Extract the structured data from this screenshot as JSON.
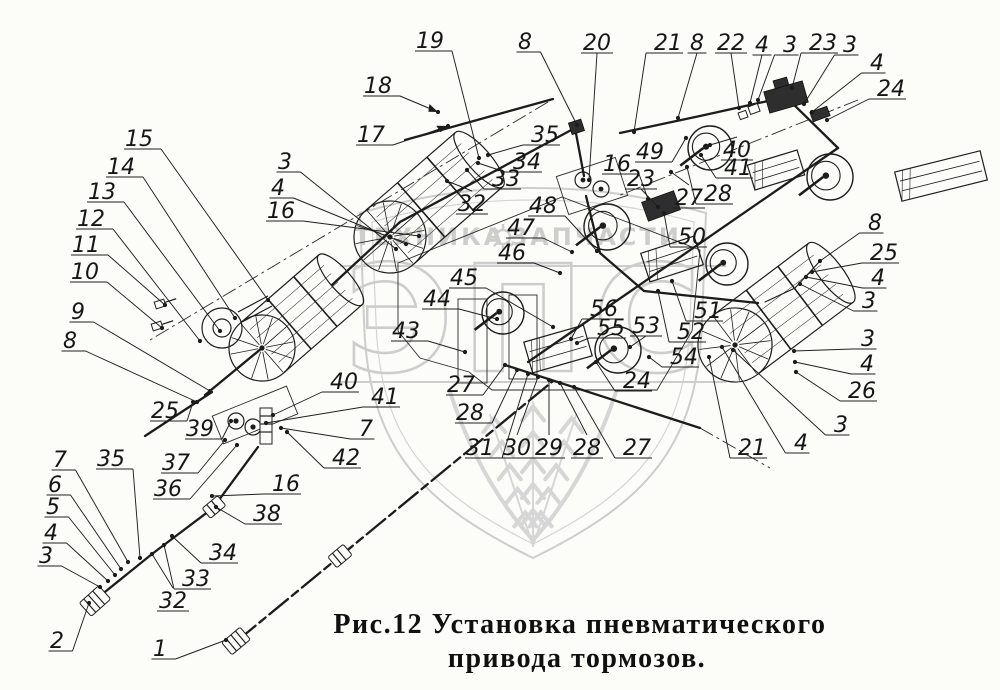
{
  "figure": {
    "caption": {
      "line1": "Рис.12 Установка пневматического",
      "line2": "привода тормозов."
    }
  },
  "watermark": {
    "brand": "ЭПС",
    "word_left": "ТЕХНИКА",
    "word_right": "ЗАПЧАСТИ",
    "color": "#cdcdcd"
  },
  "drawing": {
    "ink_color": "#1c1c1c",
    "background_color": "#fcfcf9",
    "callouts": [
      {
        "t": "19",
        "x": 430,
        "y": 40,
        "tx": 479,
        "ty": 158
      },
      {
        "t": "8",
        "x": 525,
        "y": 41,
        "tx": 577,
        "ty": 125
      },
      {
        "t": "20",
        "x": 597,
        "y": 42,
        "tx": 589,
        "ty": 180
      },
      {
        "t": "21",
        "x": 668,
        "y": 42,
        "tx": 634,
        "ty": 132
      },
      {
        "t": "8",
        "x": 697,
        "y": 42,
        "tx": 678,
        "ty": 118
      },
      {
        "t": "22",
        "x": 731,
        "y": 42,
        "tx": 739,
        "ty": 108
      },
      {
        "t": "4",
        "x": 762,
        "y": 44,
        "tx": 750,
        "ty": 103
      },
      {
        "t": "3",
        "x": 790,
        "y": 44,
        "tx": 758,
        "ty": 100
      },
      {
        "t": "23",
        "x": 823,
        "y": 42,
        "tx": 792,
        "ty": 88
      },
      {
        "t": "3",
        "x": 850,
        "y": 44,
        "tx": 804,
        "ty": 104
      },
      {
        "t": "4",
        "x": 877,
        "y": 62,
        "tx": 812,
        "ty": 112
      },
      {
        "t": "24",
        "x": 891,
        "y": 88,
        "tx": 827,
        "ty": 120
      },
      {
        "t": "18",
        "x": 378,
        "y": 85,
        "tx": 438,
        "ty": 112
      },
      {
        "t": "17",
        "x": 371,
        "y": 134,
        "tx": 448,
        "ty": 126
      },
      {
        "t": "15",
        "x": 139,
        "y": 138,
        "tx": 268,
        "ty": 300
      },
      {
        "t": "14",
        "x": 121,
        "y": 166,
        "tx": 235,
        "ty": 318
      },
      {
        "t": "13",
        "x": 102,
        "y": 191,
        "tx": 220,
        "ty": 331
      },
      {
        "t": "12",
        "x": 91,
        "y": 218,
        "tx": 200,
        "ty": 341
      },
      {
        "t": "11",
        "x": 86,
        "y": 244,
        "tx": 165,
        "ty": 305
      },
      {
        "t": "10",
        "x": 85,
        "y": 271,
        "tx": 162,
        "ty": 328
      },
      {
        "t": "9",
        "x": 78,
        "y": 311,
        "tx": 210,
        "ty": 391
      },
      {
        "t": "8",
        "x": 70,
        "y": 340,
        "tx": 197,
        "ty": 402
      },
      {
        "t": "3",
        "x": 285,
        "y": 161,
        "tx": 396,
        "ty": 249
      },
      {
        "t": "4",
        "x": 278,
        "y": 187,
        "tx": 406,
        "ty": 244
      },
      {
        "t": "16",
        "x": 281,
        "y": 210,
        "tx": 419,
        "ty": 236
      },
      {
        "t": "35",
        "x": 545,
        "y": 134,
        "tx": 488,
        "ty": 155
      },
      {
        "t": "34",
        "x": 527,
        "y": 161,
        "tx": 478,
        "ty": 163
      },
      {
        "t": "33",
        "x": 506,
        "y": 178,
        "tx": 467,
        "ty": 170
      },
      {
        "t": "32",
        "x": 472,
        "y": 203,
        "tx": 447,
        "ty": 181
      },
      {
        "t": "48",
        "x": 543,
        "y": 205,
        "tx": 597,
        "ty": 251
      },
      {
        "t": "47",
        "x": 521,
        "y": 227,
        "tx": 572,
        "ty": 252
      },
      {
        "t": "46",
        "x": 512,
        "y": 252,
        "tx": 560,
        "ty": 273
      },
      {
        "t": "45",
        "x": 464,
        "y": 277,
        "tx": 553,
        "ty": 327
      },
      {
        "t": "44",
        "x": 437,
        "y": 298,
        "tx": 497,
        "ty": 319
      },
      {
        "t": "43",
        "x": 406,
        "y": 330,
        "tx": 465,
        "ty": 352
      },
      {
        "t": "16",
        "x": 617,
        "y": 163,
        "tx": 648,
        "ty": 199
      },
      {
        "t": "23",
        "x": 641,
        "y": 178,
        "tx": 658,
        "ty": 207
      },
      {
        "t": "49",
        "x": 650,
        "y": 151,
        "tx": 686,
        "ty": 138
      },
      {
        "t": "40",
        "x": 737,
        "y": 149,
        "tx": 710,
        "ty": 145
      },
      {
        "t": "41",
        "x": 738,
        "y": 167,
        "tx": 701,
        "ty": 155
      },
      {
        "t": "27",
        "x": 689,
        "y": 197,
        "tx": 671,
        "ty": 172
      },
      {
        "t": "28",
        "x": 718,
        "y": 193,
        "tx": 687,
        "ty": 167
      },
      {
        "t": "50",
        "x": 692,
        "y": 236,
        "tx": 664,
        "ty": 213
      },
      {
        "t": "56",
        "x": 604,
        "y": 308,
        "tx": 571,
        "ty": 339
      },
      {
        "t": "55",
        "x": 611,
        "y": 327,
        "tx": 577,
        "ty": 343
      },
      {
        "t": "53",
        "x": 646,
        "y": 325,
        "tx": 630,
        "ty": 347
      },
      {
        "t": "52",
        "x": 691,
        "y": 331,
        "tx": 658,
        "ty": 291
      },
      {
        "t": "51",
        "x": 708,
        "y": 310,
        "tx": 672,
        "ty": 281
      },
      {
        "t": "54",
        "x": 684,
        "y": 356,
        "tx": 649,
        "ty": 357
      },
      {
        "t": "24",
        "x": 637,
        "y": 380,
        "tx": 596,
        "ty": 362
      },
      {
        "t": "27",
        "x": 461,
        "y": 384,
        "tx": 505,
        "ty": 365
      },
      {
        "t": "28",
        "x": 470,
        "y": 412,
        "tx": 517,
        "ty": 370
      },
      {
        "t": "31",
        "x": 480,
        "y": 447,
        "tx": 528,
        "ty": 374
      },
      {
        "t": "30",
        "x": 517,
        "y": 447,
        "tx": 538,
        "ty": 377
      },
      {
        "t": "29",
        "x": 549,
        "y": 447,
        "tx": 549,
        "ty": 380
      },
      {
        "t": "28",
        "x": 587,
        "y": 447,
        "tx": 560,
        "ty": 383
      },
      {
        "t": "27",
        "x": 637,
        "y": 447,
        "tx": 574,
        "ty": 387
      },
      {
        "t": "21",
        "x": 752,
        "y": 447,
        "tx": 709,
        "ty": 357
      },
      {
        "t": "4",
        "x": 801,
        "y": 442,
        "tx": 722,
        "ty": 347
      },
      {
        "t": "3",
        "x": 841,
        "y": 424,
        "tx": 733,
        "ty": 350
      },
      {
        "t": "3",
        "x": 868,
        "y": 338,
        "tx": 794,
        "ty": 351
      },
      {
        "t": "4",
        "x": 867,
        "y": 363,
        "tx": 795,
        "ty": 362
      },
      {
        "t": "26",
        "x": 862,
        "y": 390,
        "tx": 796,
        "ty": 372
      },
      {
        "t": "8",
        "x": 875,
        "y": 222,
        "tx": 820,
        "ty": 261
      },
      {
        "t": "25",
        "x": 884,
        "y": 252,
        "tx": 812,
        "ty": 272
      },
      {
        "t": "4",
        "x": 878,
        "y": 277,
        "tx": 806,
        "ty": 277
      },
      {
        "t": "3",
        "x": 869,
        "y": 300,
        "tx": 800,
        "ty": 284
      },
      {
        "t": "25",
        "x": 165,
        "y": 410,
        "tx": 193,
        "ty": 402
      },
      {
        "t": "39",
        "x": 200,
        "y": 428,
        "tx": 231,
        "ty": 421
      },
      {
        "t": "37",
        "x": 176,
        "y": 462,
        "tx": 225,
        "ty": 440
      },
      {
        "t": "36",
        "x": 168,
        "y": 488,
        "tx": 237,
        "ty": 445
      },
      {
        "t": "40",
        "x": 344,
        "y": 381,
        "tx": 273,
        "ty": 415
      },
      {
        "t": "41",
        "x": 385,
        "y": 396,
        "tx": 266,
        "ty": 423
      },
      {
        "t": "7",
        "x": 366,
        "y": 428,
        "tx": 281,
        "ty": 428
      },
      {
        "t": "42",
        "x": 346,
        "y": 457,
        "tx": 287,
        "ty": 432
      },
      {
        "t": "7",
        "x": 60,
        "y": 459,
        "tx": 128,
        "ty": 562
      },
      {
        "t": "6",
        "x": 55,
        "y": 484,
        "tx": 121,
        "ty": 569
      },
      {
        "t": "5",
        "x": 53,
        "y": 506,
        "tx": 115,
        "ty": 575
      },
      {
        "t": "4",
        "x": 51,
        "y": 532,
        "tx": 108,
        "ty": 581
      },
      {
        "t": "3",
        "x": 46,
        "y": 555,
        "tx": 100,
        "ty": 587
      },
      {
        "t": "35",
        "x": 111,
        "y": 458,
        "tx": 140,
        "ty": 558
      },
      {
        "t": "16",
        "x": 286,
        "y": 483,
        "tx": 212,
        "ty": 496
      },
      {
        "t": "38",
        "x": 267,
        "y": 513,
        "tx": 216,
        "ty": 507
      },
      {
        "t": "34",
        "x": 223,
        "y": 552,
        "tx": 172,
        "ty": 536
      },
      {
        "t": "33",
        "x": 196,
        "y": 578,
        "tx": 164,
        "ty": 545
      },
      {
        "t": "32",
        "x": 173,
        "y": 600,
        "tx": 152,
        "ty": 554
      },
      {
        "t": "2",
        "x": 57,
        "y": 640,
        "tx": 89,
        "ty": 603
      },
      {
        "t": "1",
        "x": 160,
        "y": 648,
        "tx": 226,
        "ty": 640
      }
    ]
  }
}
